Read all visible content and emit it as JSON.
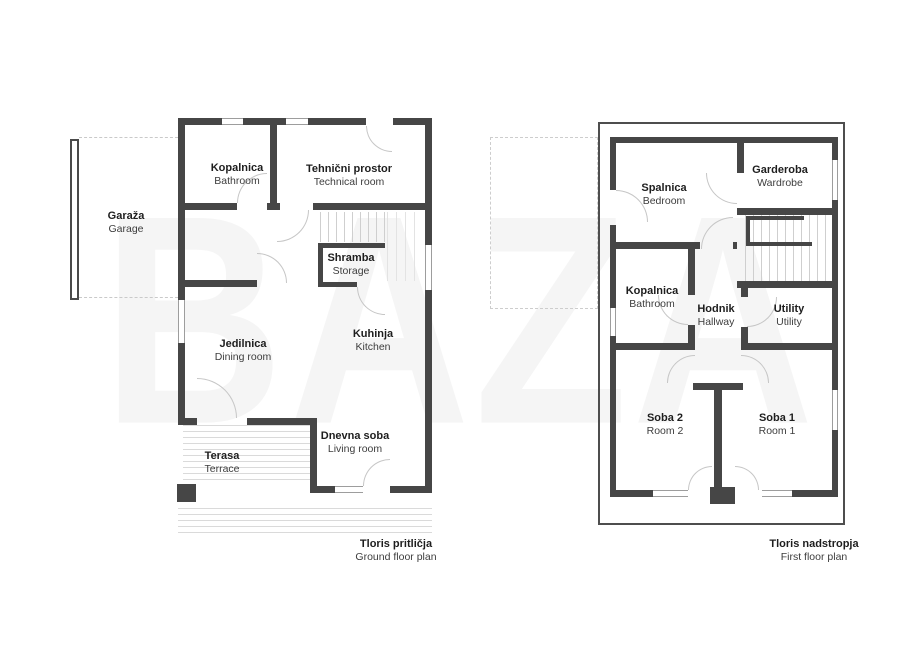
{
  "watermark": "BAZA",
  "ground": {
    "caption_sl": "Tloris pritličja",
    "caption_en": "Ground floor plan",
    "rooms": {
      "garaza": {
        "sl": "Garaža",
        "en": "Garage"
      },
      "kopalnica": {
        "sl": "Kopalnica",
        "en": "Bathroom"
      },
      "tehnicni": {
        "sl": "Tehnični prostor",
        "en": "Technical room"
      },
      "shramba": {
        "sl": "Shramba",
        "en": "Storage"
      },
      "jedilnica": {
        "sl": "Jedilnica",
        "en": "Dining room"
      },
      "kuhinja": {
        "sl": "Kuhinja",
        "en": "Kitchen"
      },
      "dnevna": {
        "sl": "Dnevna soba",
        "en": "Living room"
      },
      "terasa": {
        "sl": "Terasa",
        "en": "Terrace"
      }
    }
  },
  "first": {
    "caption_sl": "Tloris nadstropja",
    "caption_en": "First floor plan",
    "rooms": {
      "spalnica": {
        "sl": "Spalnica",
        "en": "Bedroom"
      },
      "garderoba": {
        "sl": "Garderoba",
        "en": "Wardrobe"
      },
      "kopalnica": {
        "sl": "Kopalnica",
        "en": "Bathroom"
      },
      "hodnik": {
        "sl": "Hodnik",
        "en": "Hallway"
      },
      "utility": {
        "sl": "Utility",
        "en": "Utility"
      },
      "soba2": {
        "sl": "Soba 2",
        "en": "Room 2"
      },
      "soba1": {
        "sl": "Soba 1",
        "en": "Room 1"
      }
    }
  },
  "colors": {
    "wall": "#464646",
    "door_arc": "#c6c6c6",
    "window": "#9d9d9d",
    "dashed": "#cdcdcd",
    "hatch": "#dadada",
    "text": "#1e1e1e",
    "watermark": "#f5f5f5",
    "background": "#ffffff"
  }
}
